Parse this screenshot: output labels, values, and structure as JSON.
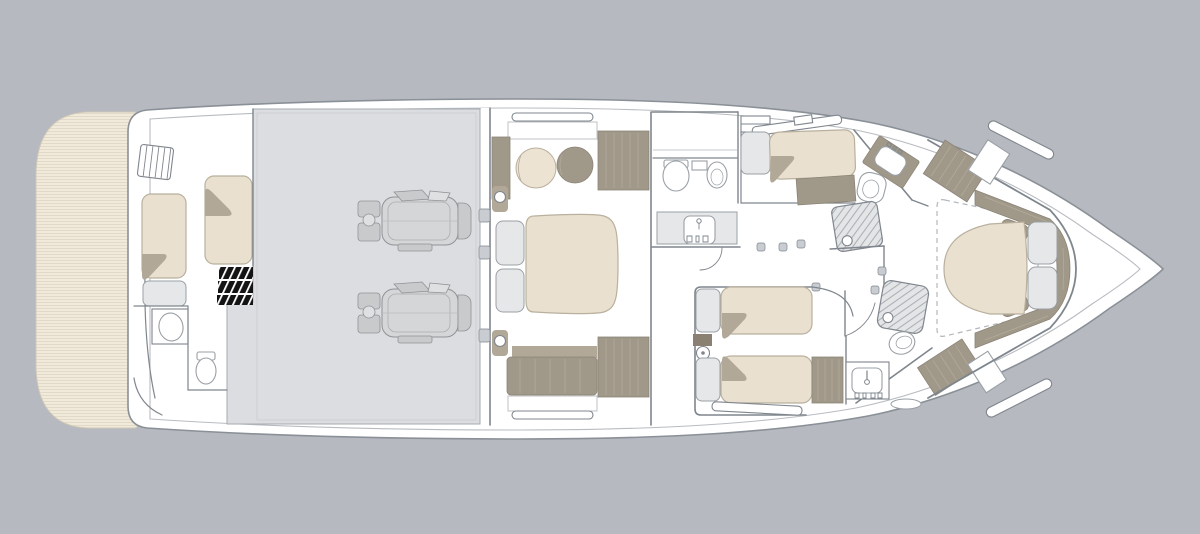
{
  "scene": {
    "type": "floor-plan",
    "subject": "motor-yacht-lower-deck",
    "orientation": "bow-right",
    "visible_text": ""
  },
  "palette": {
    "background": "#b6b9bf",
    "hull_fill": "#ffffff",
    "hull_line": "#8a9097",
    "inner_line": "#b8bcc1",
    "wall": "#7f868d",
    "engine_room": "#dcdde0",
    "engine_room_line": "#a6abb0",
    "engine_body": "#d5d6d7",
    "engine_dark": "#c9cacb",
    "engine_light": "#dfe0e1",
    "engine_line": "#8f9296",
    "teak": "#f1eadb",
    "teak_stripe": "#ded6c3",
    "mattress": "#e9e0d0",
    "mattress_edge": "#b9b09e",
    "wood": "#a09889",
    "wood_stroke": "#8c8477",
    "wood_light": "#b1a898",
    "wood_grain": "#b3aa9b",
    "wood_dark": "#8a8173",
    "fixture": "#e6e7e8",
    "fixture_line": "#9aa0a6",
    "hatch_bg": "#e4e5e6",
    "hatch_line": "#abafb4",
    "dash_line": "#b3b7bb",
    "tab": "#c9cdd1",
    "ladder": "#141414"
  },
  "areas": [
    {
      "id": "swim-platform",
      "items": [
        "teak-decking"
      ]
    },
    {
      "id": "crew-cabin",
      "items": [
        "entry-steps",
        "crew-berth-1",
        "crew-berth-2",
        "companionway-ladder",
        "seat-locker",
        "washbasin",
        "toilet"
      ]
    },
    {
      "id": "engine-room",
      "items": [
        "engine-1",
        "engine-2"
      ]
    },
    {
      "id": "master-cabin",
      "items": [
        "hull-window-1",
        "hull-window-2",
        "sideboard",
        "pouf-table",
        "armchair",
        "wardrobe-1",
        "wardrobe-2",
        "nightstand-1",
        "nightstand-2",
        "double-bed",
        "sofa"
      ]
    },
    {
      "id": "master-bathroom",
      "items": [
        "toilet",
        "bidet",
        "vanity-sink"
      ]
    },
    {
      "id": "guest-cabin-side",
      "items": [
        "hull-window",
        "headboard",
        "single-bed",
        "wardrobe"
      ]
    },
    {
      "id": "day-head",
      "items": [
        "vanity-sink",
        "toilet",
        "shower"
      ]
    },
    {
      "id": "guest-cabin-twin",
      "items": [
        "nightstand-1",
        "single-bed-1",
        "nightstand-2",
        "single-bed-2",
        "wardrobe",
        "hull-window"
      ]
    },
    {
      "id": "forward-bathroom",
      "items": [
        "vanity-sink",
        "shower",
        "toilet",
        "bath-mat",
        "wardrobe"
      ]
    },
    {
      "id": "vip-cabin",
      "items": [
        "deck-hatch-outline",
        "headboard-band",
        "double-bed",
        "bed-cushion-1",
        "bed-cushion-2",
        "nightstand-1",
        "nightstand-2",
        "wardrobe-1",
        "wardrobe-2",
        "deck-window-1",
        "deck-window-2"
      ]
    }
  ]
}
